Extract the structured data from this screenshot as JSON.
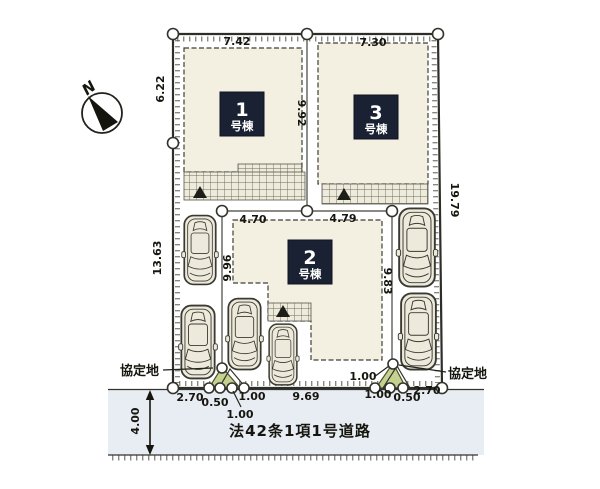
{
  "title": "区画図",
  "compass": {
    "label": "N"
  },
  "buildings": [
    {
      "number": "1",
      "suffix": "号棟"
    },
    {
      "number": "2",
      "suffix": "号棟"
    },
    {
      "number": "3",
      "suffix": "号棟"
    }
  ],
  "dims": {
    "top_left": "7.42",
    "top_right": "7.30",
    "left_upper": "6.22",
    "left_lower": "13.63",
    "right_side": "19.79",
    "mid_divider": "9.92",
    "plot2_top_left": "4.70",
    "plot2_top_right": "4.79",
    "plot2_left": "9.96",
    "plot2_right": "9.83",
    "bottom_l_270": "2.70",
    "bottom_l_050": "0.50",
    "bottom_l_100a": "1.00",
    "bottom_l_100b": "1.00",
    "bottom_969": "9.69",
    "bottom_r_100a": "1.00",
    "bottom_r_100b": "1.00",
    "bottom_r_050": "0.50",
    "bottom_r_270": "2.70",
    "road_width": "4.00"
  },
  "labels": {
    "agreement_left": "協定地",
    "agreement_right": "協定地",
    "road": "法42条1項1号道路"
  },
  "icons": {
    "north_arrow": "compass-needle",
    "boundary_marker": "white-circle",
    "entrance_mark": "triangle-up"
  },
  "colors": {
    "lot": "#ebe8d9",
    "building": "#f3f0e2",
    "navy": "#1a2133",
    "road": "#e8edf3",
    "green": "#c5d18f",
    "car": "#edeadb",
    "line": "#2e2e28"
  }
}
